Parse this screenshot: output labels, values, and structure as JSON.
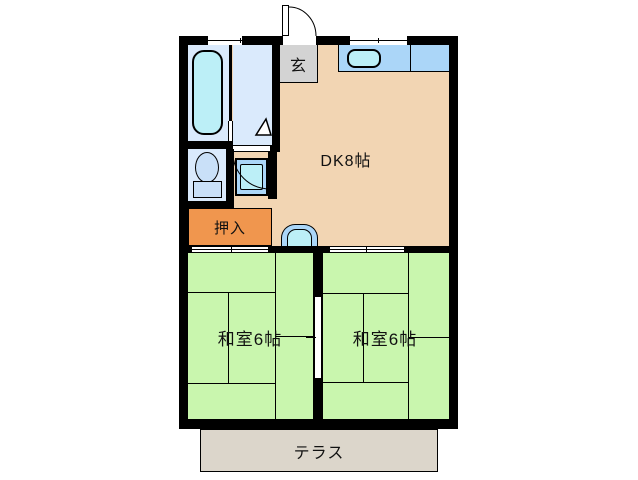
{
  "plan": {
    "type": "apartment-floor-plan",
    "rooms": {
      "dk": {
        "label": "DK8帖"
      },
      "genkan": {
        "label": "玄"
      },
      "closet": {
        "label": "押入"
      },
      "washitsu_left": {
        "label": "和室6帖"
      },
      "washitsu_right": {
        "label": "和室6帖"
      },
      "terrace": {
        "label": "テラス"
      }
    },
    "fixtures": [
      "bathtub-icon",
      "toilet-icon",
      "washing-machine-pan-icon",
      "kitchen-sink-icon",
      "washbasin-icon",
      "entrance-door-swing-icon",
      "bath-door-triangle-icon",
      "window-icon",
      "sliding-door-icon",
      "fusuma-door-icon"
    ],
    "colors": {
      "wall": "#000000",
      "dk_floor": "#F2D5B3",
      "tatami_green": "#C9F6AE",
      "bath_floor": "#DAEAFC",
      "fixture_blue": "#ABD6F8",
      "fixture_cyan": "#BCEFF7",
      "toilet_blue": "#C9E0F8",
      "closet_orange": "#F0964E",
      "genkan_gray": "#D3D3D3",
      "terrace_gray": "#DCD6CB",
      "opening_white": "#FFFFFF"
    }
  }
}
